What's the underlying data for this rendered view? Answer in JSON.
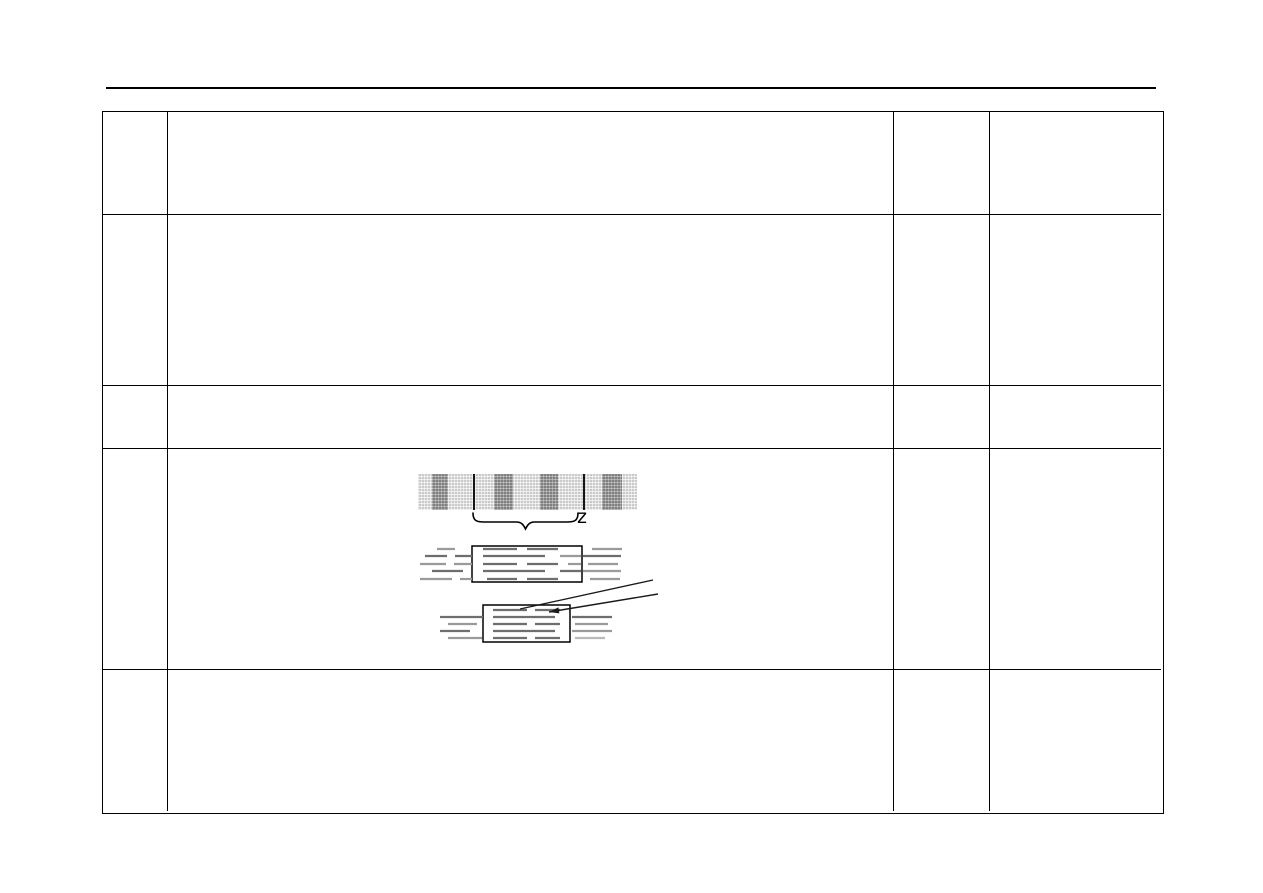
{
  "page": {
    "background": "#ffffff",
    "line_color": "#000000"
  },
  "header_rule": {
    "x": 106,
    "y": 87,
    "width": 1050,
    "thickness": 2
  },
  "table": {
    "layout": {
      "x": 102,
      "y": 111,
      "width": 1062,
      "height": 703,
      "col_widths": [
        65,
        726,
        96,
        171
      ],
      "row_heights": [
        103,
        171,
        63,
        221,
        141
      ],
      "border_color": "#000000",
      "border_px": 1.5
    },
    "cells": [
      [
        "",
        "",
        "",
        ""
      ],
      [
        "",
        "",
        "",
        ""
      ],
      [
        "",
        "",
        "",
        ""
      ],
      [
        "",
        "",
        "",
        ""
      ],
      [
        "",
        "",
        "",
        ""
      ]
    ]
  },
  "figures": {
    "stripe_bar": {
      "x": 418,
      "y": 474,
      "width": 219,
      "height": 36,
      "light_color": "#d7d7d7",
      "dark_color": "#8d8d8d",
      "divider_color": "#141414",
      "dark_stripes": [
        [
          432,
          448
        ],
        [
          494,
          513
        ],
        [
          540,
          558
        ],
        [
          602,
          622
        ]
      ],
      "dividers": [
        473,
        583
      ]
    },
    "brace": {
      "x1": 473,
      "x2": 578,
      "y_top": 513,
      "y_body": 522,
      "y_tip": 529,
      "label": "z",
      "label_x": 577,
      "label_y": 508,
      "color": "#000000"
    },
    "pattern_boxes": [
      {
        "rect": [
          472,
          546,
          110,
          36
        ],
        "rows": [
          {
            "y": 549,
            "dashes": [
              [
                437,
                455,
                "m"
              ],
              [
                483,
                517,
                "d"
              ],
              [
                527,
                558,
                "d"
              ],
              [
                592,
                622,
                "m"
              ]
            ]
          },
          {
            "y": 556,
            "dashes": [
              [
                425,
                447,
                "d"
              ],
              [
                455,
                472,
                "d"
              ],
              [
                483,
                545,
                "d"
              ],
              [
                560,
                581,
                "m"
              ],
              [
                583,
                621,
                "d"
              ]
            ]
          },
          {
            "y": 564,
            "dashes": [
              [
                420,
                446,
                "m"
              ],
              [
                454,
                472,
                "m"
              ],
              [
                483,
                517,
                "d"
              ],
              [
                527,
                558,
                "d"
              ],
              [
                568,
                581,
                "m"
              ],
              [
                588,
                618,
                "m"
              ]
            ]
          },
          {
            "y": 571,
            "dashes": [
              [
                432,
                463,
                "d"
              ],
              [
                483,
                545,
                "d"
              ],
              [
                560,
                581,
                "d"
              ],
              [
                583,
                621,
                "m"
              ]
            ]
          },
          {
            "y": 579,
            "dashes": [
              [
                420,
                452,
                "m"
              ],
              [
                460,
                472,
                "m"
              ],
              [
                487,
                517,
                "d"
              ],
              [
                527,
                558,
                "d"
              ],
              [
                590,
                620,
                "m"
              ]
            ]
          }
        ]
      },
      {
        "rect": [
          483,
          605,
          87,
          37
        ],
        "rows": [
          {
            "y": 610,
            "dashes": [
              [
                493,
                527,
                "d"
              ],
              [
                535,
                560,
                "d"
              ]
            ]
          },
          {
            "y": 617,
            "dashes": [
              [
                440,
                483,
                "d"
              ],
              [
                493,
                555,
                "d"
              ],
              [
                572,
                612,
                "d"
              ]
            ]
          },
          {
            "y": 624,
            "dashes": [
              [
                448,
                477,
                "m"
              ],
              [
                493,
                527,
                "d"
              ],
              [
                535,
                560,
                "d"
              ],
              [
                575,
                608,
                "m"
              ]
            ]
          },
          {
            "y": 631,
            "dashes": [
              [
                440,
                470,
                "d"
              ],
              [
                493,
                555,
                "d"
              ],
              [
                572,
                612,
                "m"
              ]
            ]
          },
          {
            "y": 638,
            "dashes": [
              [
                448,
                482,
                "m"
              ],
              [
                493,
                527,
                "d"
              ],
              [
                535,
                560,
                "d"
              ],
              [
                575,
                605,
                "l"
              ]
            ]
          }
        ]
      }
    ],
    "dash_colors": {
      "d": "#6e6e6e",
      "m": "#9a9a9a",
      "l": "#b9b9b9"
    },
    "leader_lines": [
      {
        "x1": 653,
        "y1": 580,
        "x2": 520,
        "y2": 609,
        "arrow": false
      },
      {
        "x1": 658,
        "y1": 594,
        "x2": 549,
        "y2": 612,
        "arrow": true
      }
    ]
  }
}
